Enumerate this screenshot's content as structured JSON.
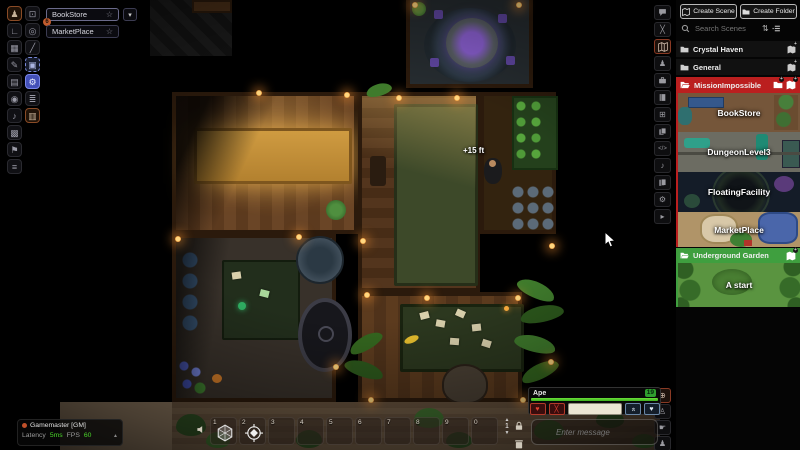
{
  "icons": {
    "person": "♟",
    "angle_ruler": "∟",
    "tiles": "▦",
    "pencil": "✎",
    "wall": "▤",
    "bulb": "◉",
    "music": "♪",
    "board": "▩",
    "flag": "⚑",
    "list": "≡",
    "select": "⊡",
    "target": "◎",
    "diag": "╱",
    "bag": "▣",
    "gear": "⚙",
    "layers": "≣",
    "film": "▥",
    "combat": "╳",
    "tables": "⊞",
    "macros": "</>",
    "collapse": "▸",
    "globe": "⊕",
    "pawn": "♙",
    "hand": "☛",
    "star": "☆",
    "caret_down": "▾",
    "up": "▲",
    "down": "▼",
    "heart": "♥",
    "cross": "╳",
    "chevrons": "«",
    "sort": "⇅",
    "plus": "+"
  },
  "scene_nav": {
    "scenes": [
      {
        "name": "BookStore",
        "badge": "6"
      },
      {
        "name": "MarketPlace"
      }
    ]
  },
  "canvas": {
    "elevation": "+15 ft"
  },
  "sidebar": {
    "create_scene": "Create Scene",
    "create_folder": "Create Folder",
    "search_placeholder": "Search Scenes",
    "folders": {
      "crystal": "Crystal Haven",
      "general": "General",
      "mission": "MissionImpossible",
      "underground": "Underground Garden"
    },
    "scenes": {
      "bookstore": "BookStore",
      "dungeon": "DungeonLevel3",
      "floating": "FloatingFacility",
      "market": "MarketPlace",
      "astart": "A start"
    }
  },
  "status": {
    "player": "Gamemaster [GM]",
    "latency_label": "Latency",
    "latency_value": "5ms",
    "fps_label": "FPS",
    "fps_value": "60"
  },
  "hotbar": {
    "page": "1",
    "slots": [
      "1",
      "2",
      "3",
      "4",
      "5",
      "6",
      "7",
      "8",
      "9",
      "0"
    ]
  },
  "chat": {
    "placeholder": "Enter message"
  },
  "token_hud": {
    "name": "Ape",
    "value": "19"
  },
  "colors": {
    "folder_red": "#bb1f1f",
    "folder_green": "#3f9f3f",
    "hp_green": "#52d428"
  }
}
